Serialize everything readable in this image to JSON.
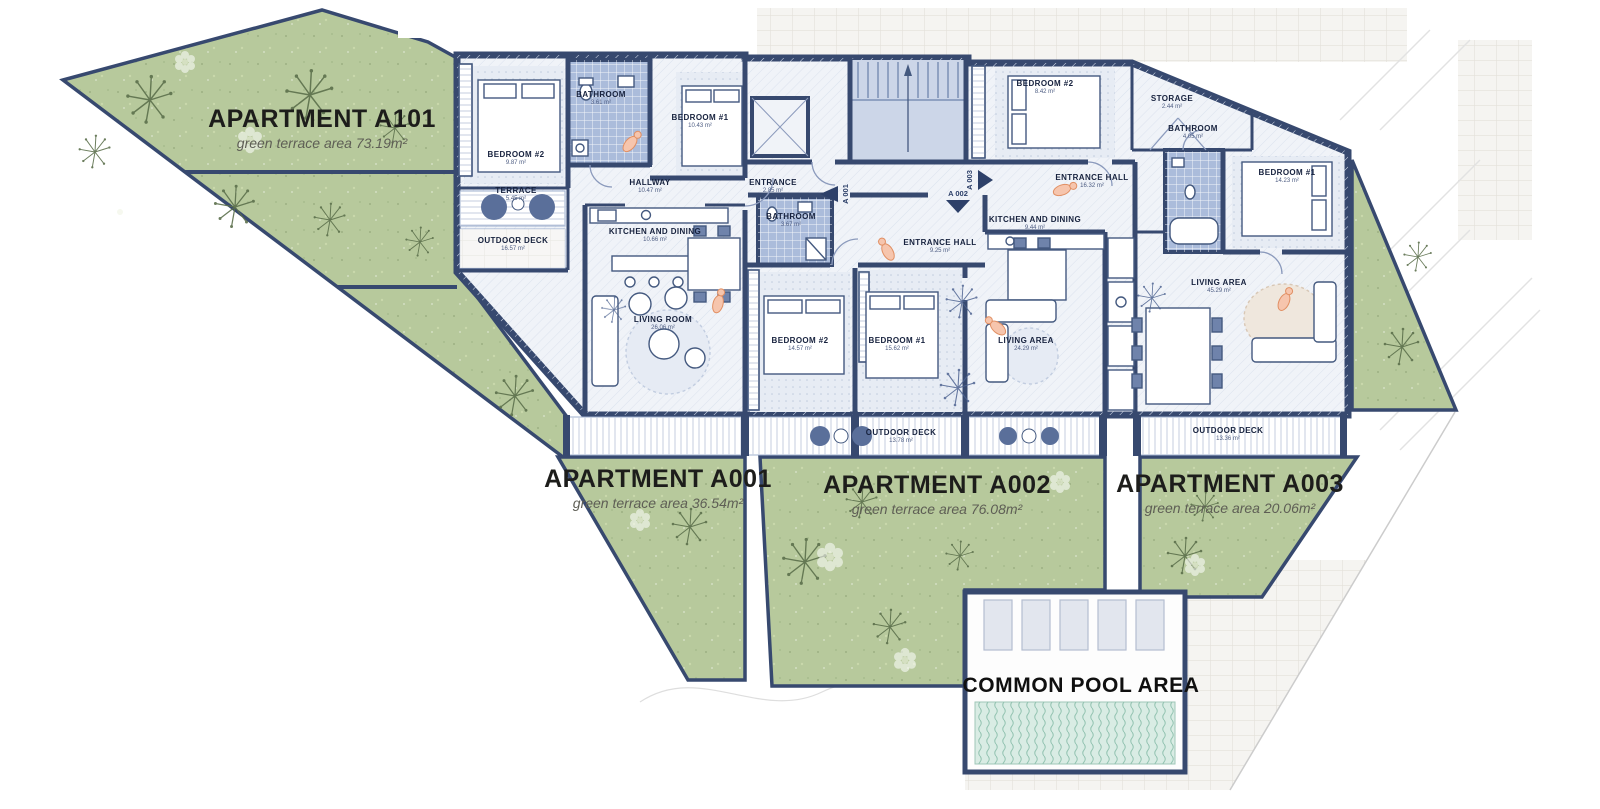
{
  "plan": {
    "apartments": {
      "a101": {
        "title": "APARTMENT A101",
        "subtitle": "green terrace area 73.19m²"
      },
      "a001": {
        "title": "APARTMENT A001",
        "subtitle": "green terrace area 36.54m²"
      },
      "a002": {
        "title": "APARTMENT A002",
        "subtitle": "green terrace area 76.08m²"
      },
      "a003": {
        "title": "APARTMENT A003",
        "subtitle": "green terrace area 20.06m²"
      }
    },
    "common_pool_label": "COMMON POOL AREA",
    "entrance_markers": {
      "a001": "A 001",
      "a002": "A 002",
      "a003": "A 003"
    },
    "rooms": {
      "a101_bedroom2": {
        "name": "BEDROOM #2",
        "area": "9.87 m²"
      },
      "a101_bathroom": {
        "name": "BATHROOM",
        "area": "3.61 m²"
      },
      "a101_bedroom1": {
        "name": "BEDROOM #1",
        "area": "10.43 m²"
      },
      "a101_hallway": {
        "name": "HALLWAY",
        "area": "10.47 m²"
      },
      "a101_entrance": {
        "name": "ENTRANCE",
        "area": "2.85 m²"
      },
      "a101_terrace": {
        "name": "TERRACE",
        "area": "5.45 m²"
      },
      "a101_outdoor_deck": {
        "name": "OUTDOOR DECK",
        "area": "16.57 m²"
      },
      "a101_kitchen": {
        "name": "KITCHEN AND DINING",
        "area": "10.66 m²"
      },
      "a101_living": {
        "name": "LIVING ROOM",
        "area": "26.06 m²"
      },
      "a002_bathroom": {
        "name": "BATHROOM",
        "area": "3.67 m²"
      },
      "a002_entrance_hall": {
        "name": "ENTRANCE HALL",
        "area": "9.25 m²"
      },
      "a002_kitchen": {
        "name": "KITCHEN AND DINING",
        "area": "9.44 m²"
      },
      "a002_bedroom2": {
        "name": "BEDROOM #2",
        "area": "14.57 m²"
      },
      "a002_bedroom1": {
        "name": "BEDROOM #1",
        "area": "15.62 m²"
      },
      "a002_living": {
        "name": "LIVING AREA",
        "area": "24.29 m²"
      },
      "a002_outdoor_deck": {
        "name": "OUTDOOR DECK",
        "area": "13.78 m²"
      },
      "a003_bedroom2": {
        "name": "BEDROOM #2",
        "area": "8.42 m²"
      },
      "a003_storage": {
        "name": "STORAGE",
        "area": "2.44 m²"
      },
      "a003_entrance_hall": {
        "name": "ENTRANCE HALL",
        "area": "16.32 m²"
      },
      "a003_bathroom": {
        "name": "BATHROOM",
        "area": "4.05 m²"
      },
      "a003_bedroom1": {
        "name": "BEDROOM #1",
        "area": "14.23 m²"
      },
      "a003_living": {
        "name": "LIVING AREA",
        "area": "45.29 m²"
      },
      "a003_outdoor_deck": {
        "name": "OUTDOOR DECK",
        "area": "13.36 m²"
      }
    },
    "colors": {
      "wall": "#37496f",
      "green": "#b7c99c",
      "floor_light": "#f0f3f8",
      "bathroom_tile": "#abbcdb",
      "pool_water": "#d9ece4",
      "accent_people": "#f6c5ad",
      "paving": "#f5f4f1"
    }
  }
}
